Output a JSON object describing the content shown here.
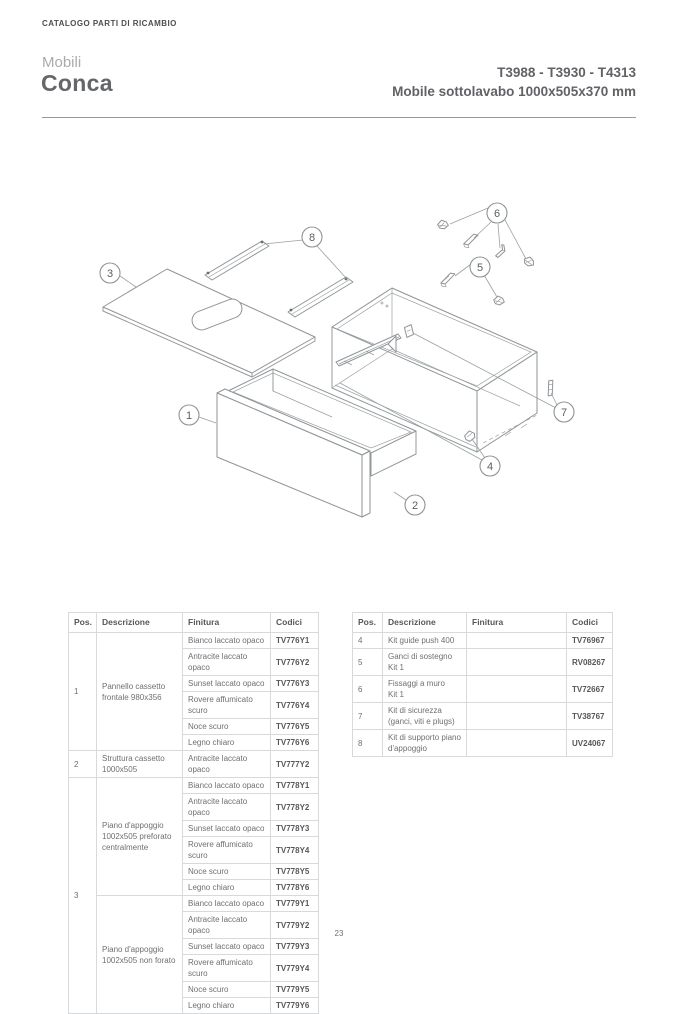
{
  "page": {
    "eyebrow": "CATALOGO PARTI DI RICAMBIO",
    "series_label": "Mobili",
    "product_name": "Conca",
    "model_codes": "T3988 - T3930 - T4313",
    "product_subtitle": "Mobile sottolavabo 1000x505x370 mm",
    "page_number": "23"
  },
  "diagram": {
    "callouts": [
      {
        "n": "1"
      },
      {
        "n": "2"
      },
      {
        "n": "3"
      },
      {
        "n": "4"
      },
      {
        "n": "5"
      },
      {
        "n": "6"
      },
      {
        "n": "7"
      },
      {
        "n": "8"
      }
    ]
  },
  "table_headers": {
    "pos": "Pos.",
    "descrizione": "Descrizione",
    "finitura": "Finitura",
    "codici": "Codici"
  },
  "left_table": {
    "rows": [
      {
        "pos": "1",
        "desc": "Pannello cassetto\nfrontale 980x356",
        "finishes": [
          [
            "Bianco laccato opaco",
            "TV776Y1"
          ],
          [
            "Antracite laccato opaco",
            "TV776Y2"
          ],
          [
            "Sunset laccato opaco",
            "TV776Y3"
          ],
          [
            "Rovere affumicato scuro",
            "TV776Y4"
          ],
          [
            "Noce scuro",
            "TV776Y5"
          ],
          [
            "Legno chiaro",
            "TV776Y6"
          ]
        ]
      },
      {
        "pos": "2",
        "desc": "Struttura cassetto\n1000x505",
        "finishes": [
          [
            "Antracite laccato opaco",
            "TV777Y2"
          ]
        ]
      },
      {
        "pos": "3",
        "groups": [
          {
            "desc": "Piano d'appoggio\n1002x505 preforato\ncentralmente",
            "finishes": [
              [
                "Bianco laccato opaco",
                "TV778Y1"
              ],
              [
                "Antracite laccato opaco",
                "TV778Y2"
              ],
              [
                "Sunset laccato opaco",
                "TV778Y3"
              ],
              [
                "Rovere affumicato scuro",
                "TV778Y4"
              ],
              [
                "Noce scuro",
                "TV778Y5"
              ],
              [
                "Legno chiaro",
                "TV778Y6"
              ]
            ]
          },
          {
            "desc": "Piano d'appoggio\n1002x505 non forato",
            "finishes": [
              [
                "Bianco laccato opaco",
                "TV779Y1"
              ],
              [
                "Antracite laccato opaco",
                "TV779Y2"
              ],
              [
                "Sunset laccato opaco",
                "TV779Y3"
              ],
              [
                "Rovere affumicato scuro",
                "TV779Y4"
              ],
              [
                "Noce scuro",
                "TV779Y5"
              ],
              [
                "Legno chiaro",
                "TV779Y6"
              ]
            ]
          }
        ]
      }
    ]
  },
  "right_table": {
    "rows": [
      {
        "pos": "4",
        "desc": "Kit guide push 400",
        "finitura": "",
        "code": "TV76967"
      },
      {
        "pos": "5",
        "desc": "Ganci di sostegno\nKit 1",
        "finitura": "",
        "code": "RV08267"
      },
      {
        "pos": "6",
        "desc": "Fissaggi a muro\nKit 1",
        "finitura": "",
        "code": "TV72667"
      },
      {
        "pos": "7",
        "desc": "Kit di sicurezza\n(ganci, viti e plugs)",
        "finitura": "",
        "code": "TV38767"
      },
      {
        "pos": "8",
        "desc": "Kit di supporto piano\nd'appoggio",
        "finitura": "",
        "code": "UV24067"
      }
    ]
  },
  "colors": {
    "text_dark": "#58595b",
    "text_body": "#6d6f72",
    "text_light": "#a9abae",
    "border_light": "#d8d9da",
    "diagram_stroke": "#8f9497"
  }
}
